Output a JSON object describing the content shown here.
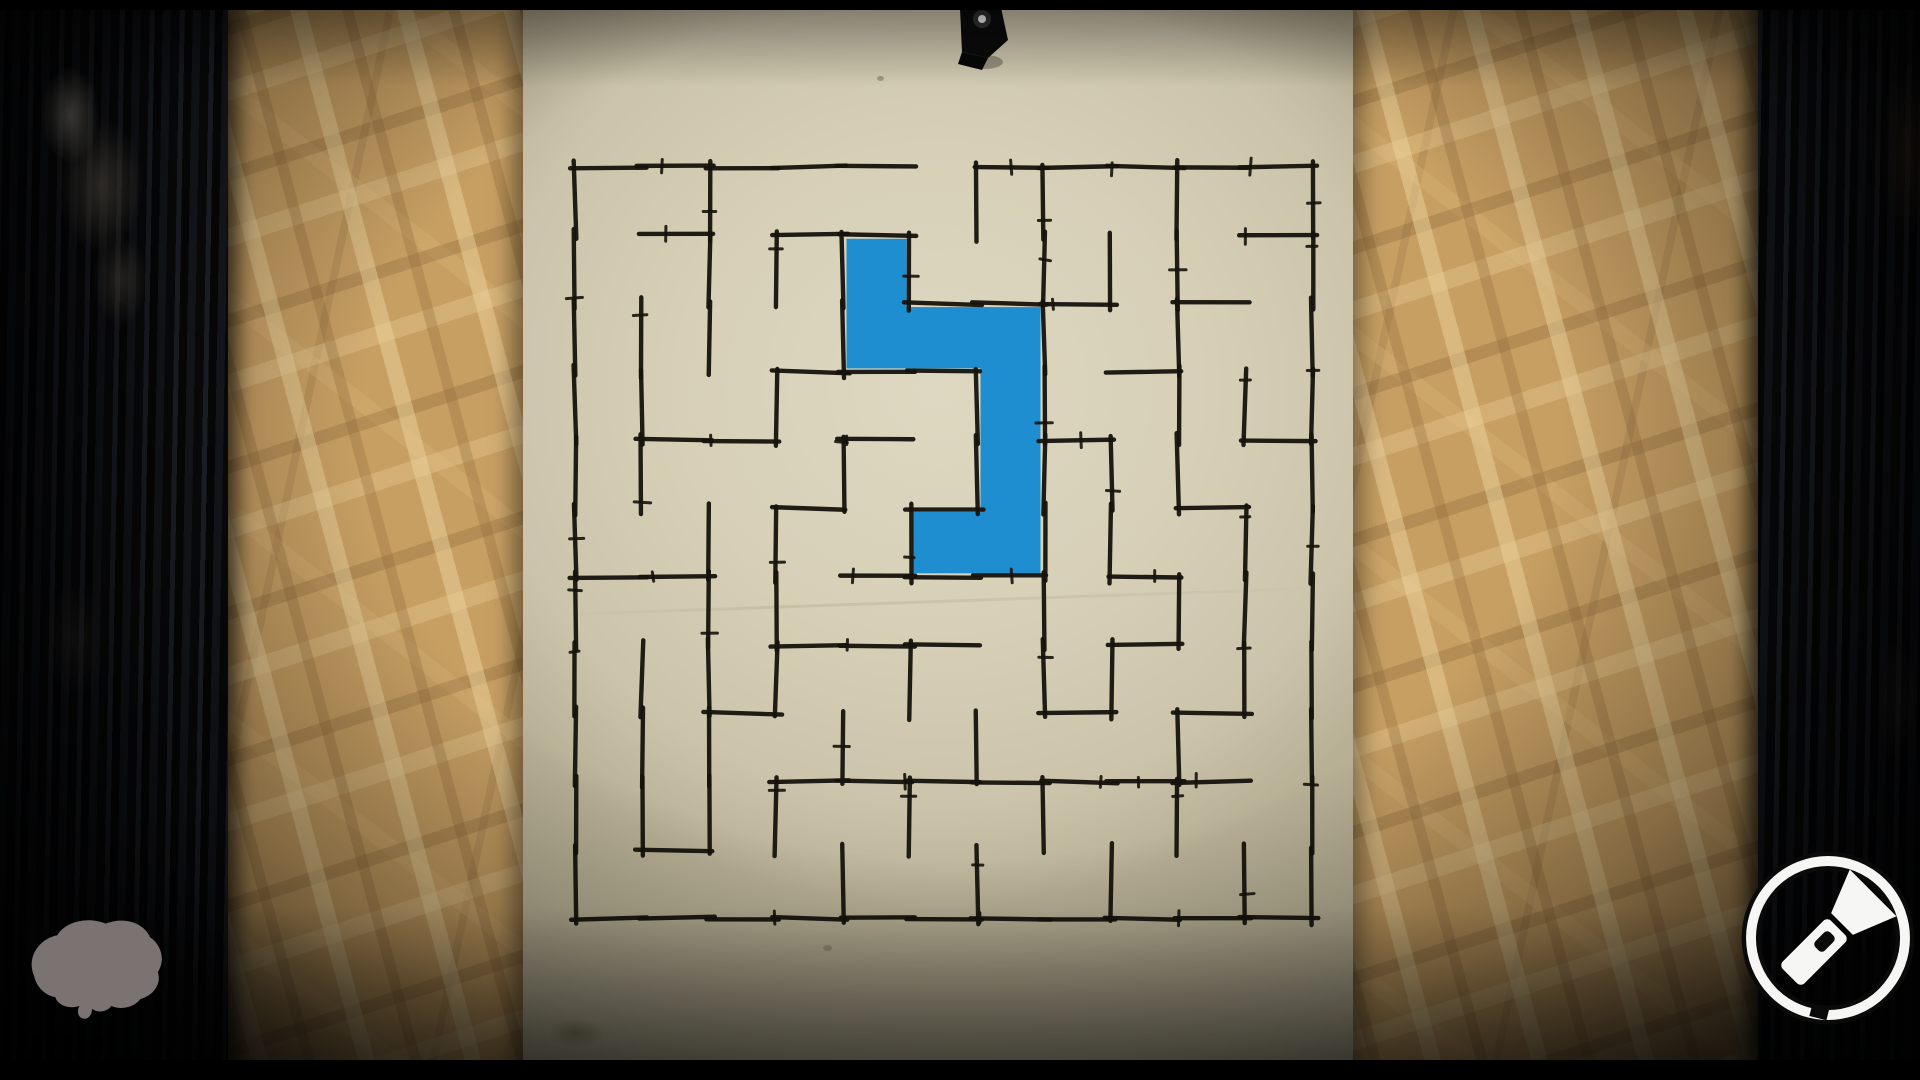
{
  "scene": {
    "view": "maze-poster-on-board",
    "letterbox_bars": true
  },
  "colors": {
    "letterbox": "#000000",
    "beam_dark": "#14151a",
    "osb_base": "#c79f63",
    "paper": "#d7d0b7",
    "ink": "#16130d",
    "path_blue": "#1e8ed0",
    "brain_gray": "#7b7272",
    "flashlight_white": "#f6f6f4",
    "ring_black": "#0a0a0a",
    "pin_black": "#0b0b0b"
  },
  "poster": {
    "pin": {
      "icon": "push-pin-icon",
      "color": "#0b0b0b"
    },
    "maze": {
      "cols": 11,
      "rows": 11,
      "origin_x": 575,
      "origin_y": 167,
      "cell_w": 67,
      "cell_h": 68.3,
      "entrance": {
        "side": "top",
        "col": 5
      },
      "h_walls": [
        "11111011111",
        "01011000001",
        "00000111010",
        "00011100100",
        "01101001001",
        "00010100010",
        "11001110100",
        "00011100100",
        "00100001010",
        "00011111110",
        "01000000000",
        "11111111111"
      ],
      "v_walls": [
        "11111111111",
        "00111001110",
        "11100111110",
        "01010111010",
        "01101000101",
        "01000101010",
        "10011000101",
        "11111111010",
        "01001101001",
        "11111010110",
        "00010111001",
        "11111111111"
      ],
      "drawn_path_cells": [
        [
          4,
          1
        ],
        [
          4,
          2
        ],
        [
          5,
          2
        ],
        [
          6,
          2
        ],
        [
          6,
          3
        ],
        [
          6,
          4
        ],
        [
          6,
          5
        ],
        [
          5,
          5
        ]
      ],
      "drawn_path_color": "#1e8ed0"
    }
  },
  "hud": {
    "brain_icon": {
      "icon": "brain-icon",
      "color": "#7b7272"
    },
    "flashlight_button": {
      "icon": "flashlight-icon",
      "ring_color": "#f6f6f4",
      "glyph_color": "#f6f6f4"
    }
  }
}
